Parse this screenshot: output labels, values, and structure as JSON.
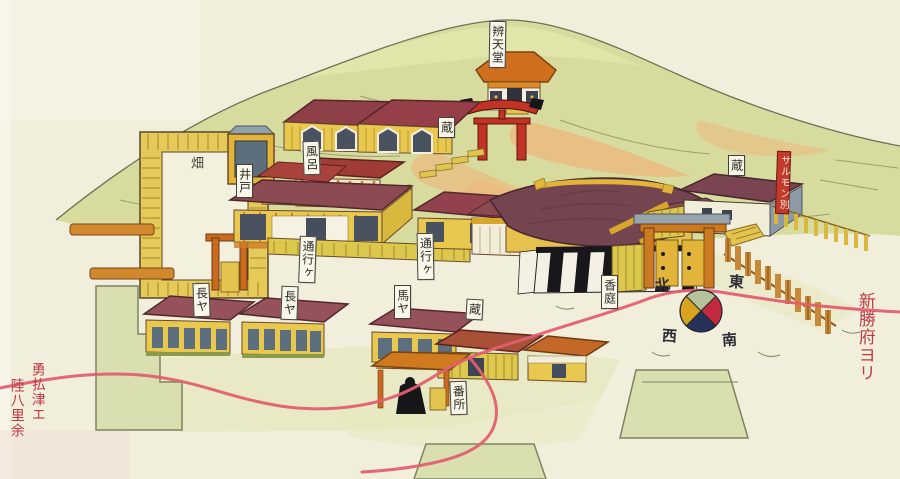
{
  "labels": {
    "benten_hall": "辨天堂",
    "storehouse_hillside": "蔵",
    "bath": "風呂",
    "well": "井戸",
    "field": "畑",
    "passage_upper": "通行ヶ",
    "passage_lower": "通行ヶ",
    "rowhouse_west": "長ヤ",
    "rowhouse_east": "長ヤ",
    "stable": "馬ヤ",
    "storehouse_middle": "蔵",
    "storehouse_east": "蔵",
    "guard_post": "番所",
    "incense_garden": "香庭",
    "place_cartouche": "サルモン別"
  },
  "compass": {
    "north": "北",
    "east": "東",
    "south": "南",
    "west": "西",
    "quadrant_colors": {
      "north": "#b6c29a",
      "east": "#c22a40",
      "south": "#273159",
      "west": "#d8a31e"
    }
  },
  "route_notes": {
    "right_destination": "新勝府ヨリ",
    "left_destination_line1": "勇払津エ",
    "left_destination_line2": "陸八里余"
  },
  "colors": {
    "paper": "#f2eedc",
    "hillside_green": "#d7dc9e",
    "hillside_orange": "#ecb87e",
    "roof_maroon": "#8c4a52",
    "roof_orange": "#d07a1f",
    "wall_yellow": "#e8c84f",
    "curtain_black": "#17171c",
    "route_red": "#e25f70",
    "note_red": "#bc3a44"
  }
}
